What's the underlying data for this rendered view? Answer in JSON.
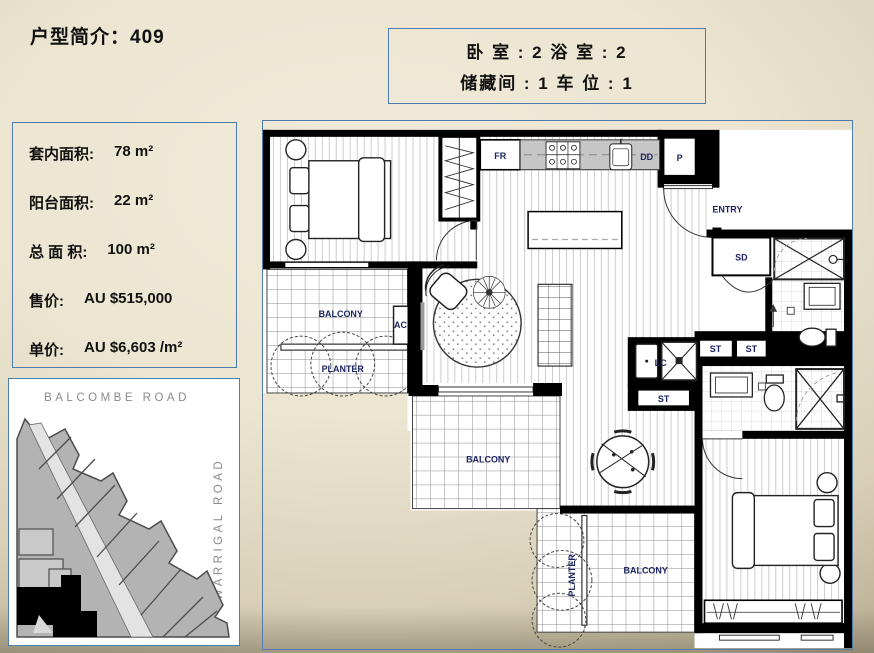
{
  "title": "户型简介：409",
  "summary_box": {
    "line1": "卧 室 : 2  浴 室 : 2",
    "line2": "储藏间 : 1  车 位 : 1"
  },
  "info_panel": {
    "rows": [
      {
        "label": "套内面积:",
        "value": "78 m²"
      },
      {
        "label": "阳台面积:",
        "value": "22 m²"
      },
      {
        "label": "总 面 积:",
        "value": "100 m²"
      },
      {
        "label": "售价:",
        "value": "AU $515,000"
      },
      {
        "label": "单价:",
        "value": "AU $6,603 /m²"
      }
    ]
  },
  "site_map": {
    "top_road": "BALCOMBE ROAD",
    "right_road": "WARRIGAL ROAD"
  },
  "floorplan": {
    "labels": {
      "fridge": "FR",
      "dishwasher": "DD",
      "pantry": "P",
      "entry": "ENTRY",
      "sliding_door": "SD",
      "storage": "ST",
      "laundry": "LC",
      "air_conditioner": "AC",
      "balcony": "BALCONY",
      "planter": "PLANTER"
    }
  },
  "colors": {
    "panel_border": "#4f7cb0",
    "plan_label": "#1d2463",
    "counter": "#c6c6c6",
    "map_parcel": "#b3b3b3",
    "map_road_label": "#8a8a8a",
    "background_center": "#f0ebd9",
    "background_edge": "#a89e82"
  }
}
